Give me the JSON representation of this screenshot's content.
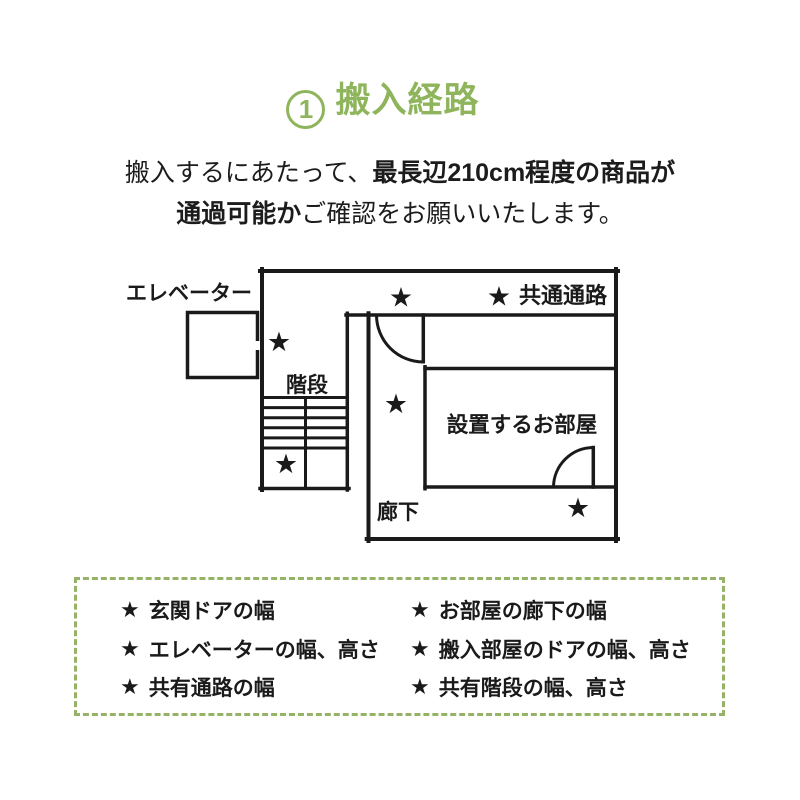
{
  "title": {
    "number": "1",
    "text": "搬入経路"
  },
  "intro": {
    "line1_regular": "搬入するにあたって、",
    "line1_bold": "最長辺210cm程度の商品が",
    "line2_bold": "通過可能か",
    "line2_regular": "ご確認をお願いいたします。"
  },
  "colors": {
    "accent_green": "#8fb55c",
    "dashed_border_green": "#95b267",
    "line_black": "#1a1a1a"
  },
  "floorplan": {
    "labels": {
      "elevator": "エレベーター",
      "common_passage": "共通通路",
      "stairs": "階段",
      "room": "設置するお部屋",
      "corridor": "廊下"
    },
    "star_icon": "★"
  },
  "checklist": {
    "bullet": "★",
    "left": [
      "玄関ドアの幅",
      "エレベーターの幅、高さ",
      "共有通路の幅"
    ],
    "right": [
      "お部屋の廊下の幅",
      "搬入部屋のドアの幅、高さ",
      "共有階段の幅、高さ"
    ]
  }
}
